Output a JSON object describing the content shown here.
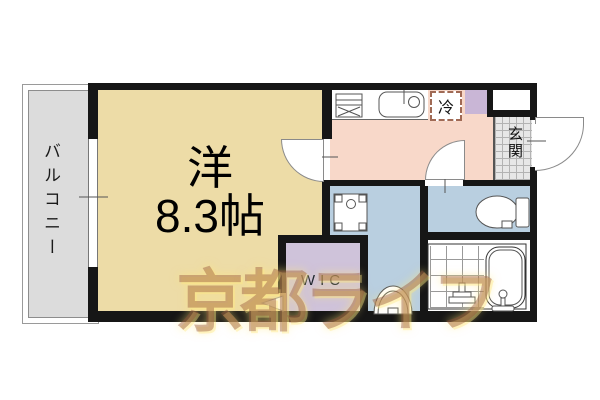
{
  "watermark_text": "京都ライフ",
  "wall_color": "#161616",
  "rooms": {
    "balcony": {
      "label": "バルコニー",
      "fill": "#dcdcdc"
    },
    "living": {
      "type_label": "洋",
      "size_label": "8.3帖",
      "fill": "#eddca7"
    },
    "kitchen_hall": {
      "fill": "#f8d8c9"
    },
    "entrance": {
      "label": "玄関"
    },
    "wic": {
      "label": "WIC",
      "fill": "#cfc3da"
    },
    "washroom": {
      "fill": "#b9cfe0"
    },
    "toilet": {
      "fill": "#b9cfe0"
    },
    "bathroom": {
      "fill": "#ffffff"
    },
    "shoe_closet": {
      "fill": "#c9b6d6"
    }
  },
  "fridge": {
    "label": "冷"
  }
}
